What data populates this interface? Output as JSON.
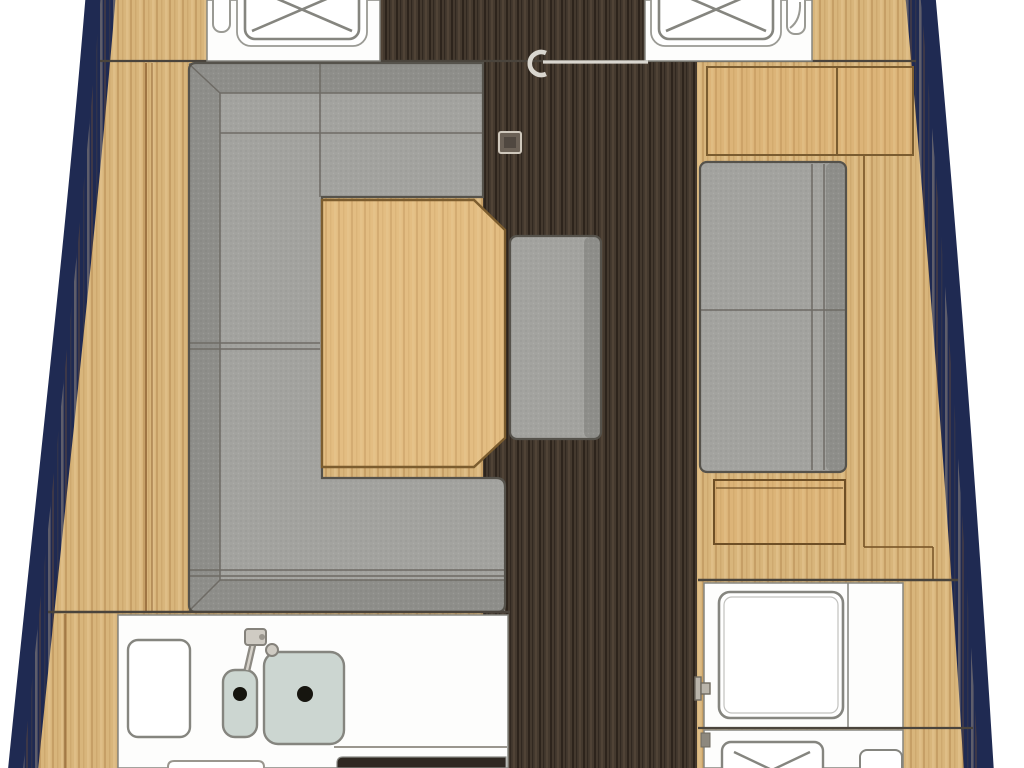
{
  "meta": {
    "title": "Sailboat interior floor plan (top-down): saloon with U-settee and table, galley with twin sinks, aft nav station",
    "view": "overhead-deck-plan",
    "visible_text": []
  },
  "palette": {
    "background": "#ffffff",
    "hull_stroke": "#1f2a52",
    "deck_wood": "#d8b57b",
    "table_wood": "#e3bd82",
    "panel_wood": "#dcb478",
    "walkway_dark": "#44392e",
    "upholstery": "#a3a39f",
    "upholstery_back": "#8e8e8a",
    "upholstery_outline": "#55524b",
    "fixture_white": "#fdfdfc",
    "fixture_outline": "#85857f",
    "sink_basin": "#ccd6d1",
    "sink_drain": "#16150f",
    "bulkhead_line": "#4a443c",
    "plank_line": "#8c6030",
    "stove_dark": "#2f2822",
    "metal_light": "#d9d6cf",
    "fitting_gray": "#6b6156"
  },
  "areas": {
    "hull": "boat hull with navy gunwale band",
    "foredeck_hatches": "two deck hatches with X braces and slider tracks",
    "companionway": "sliding hatch rail with pull hook on centerline walkway",
    "mast_fitting": "square deck fitting on walkway",
    "saloon": "U-shaped upholstered settee around chamfered wood table with ottoman stool",
    "starboard_bench": "straight upholstered bench with sideboard cabinet",
    "galley": "counter with chopping board, faucet, small and large sinks, stove front",
    "nav_station": "chart table, locker with X brace, door handle"
  }
}
